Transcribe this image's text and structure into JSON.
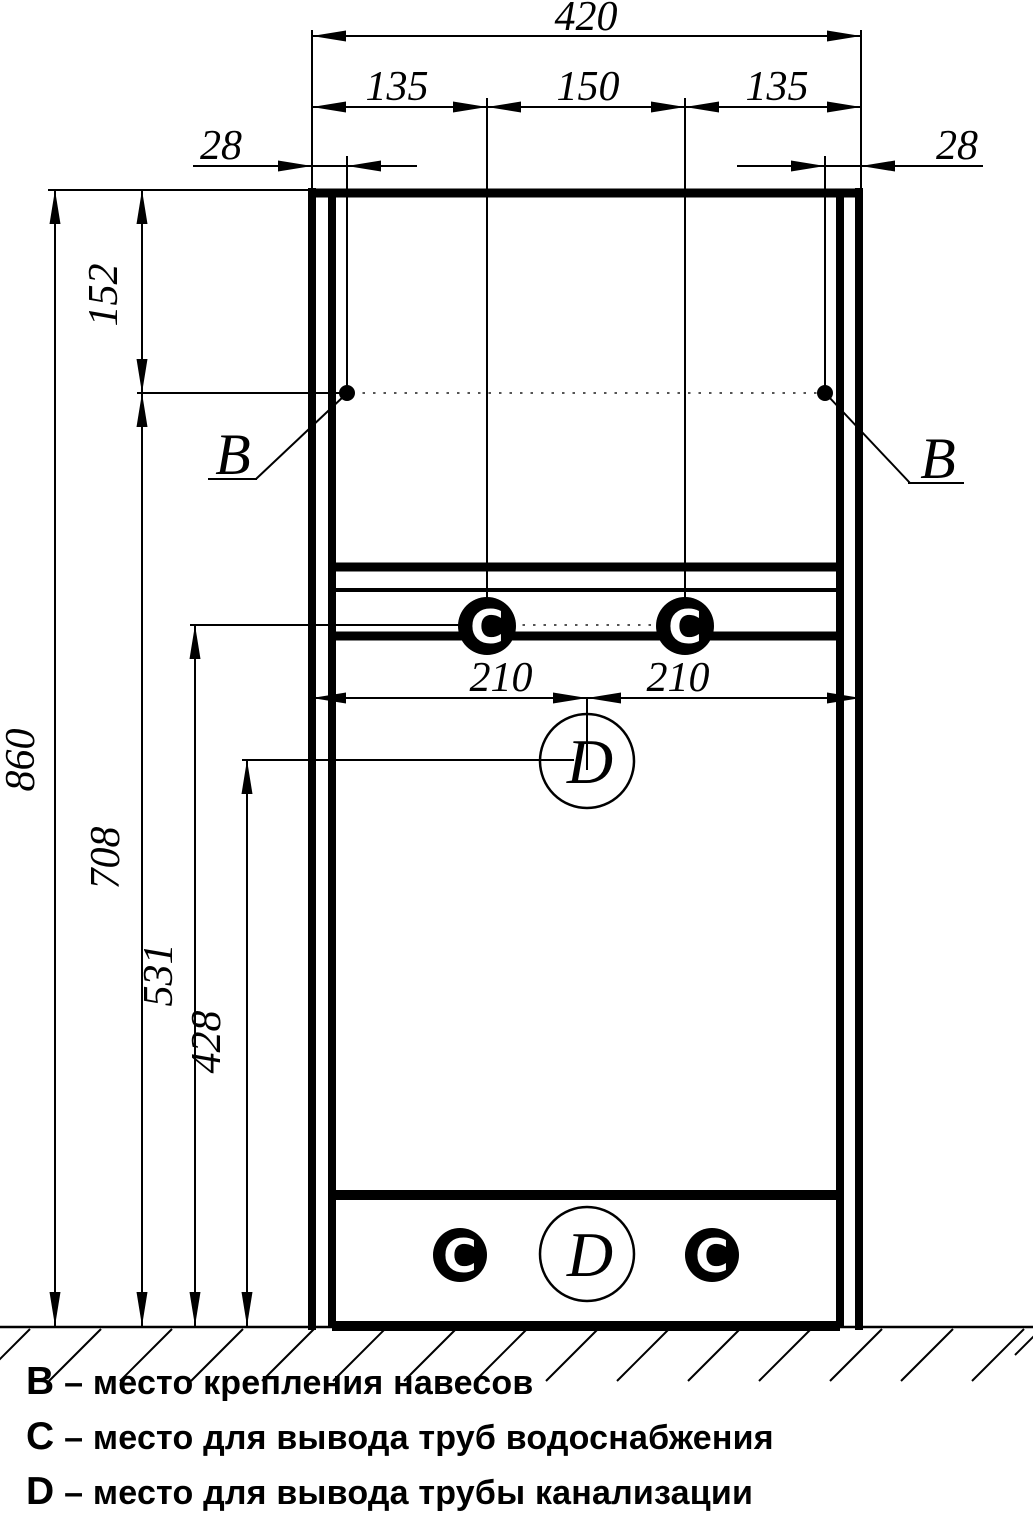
{
  "drawing": {
    "dims": {
      "total_width": "420",
      "seg_left": "135",
      "seg_mid": "150",
      "seg_right": "135",
      "edge_left": "28",
      "edge_right": "28",
      "total_height": "860",
      "top_offset": "152",
      "pipe_level": "708",
      "mid_level": "531",
      "drain_level": "428",
      "half_left": "210",
      "half_right": "210"
    },
    "markers": {
      "hinge": "B",
      "water": "C",
      "drain": "D"
    }
  },
  "legend": {
    "items": [
      {
        "key": "B",
        "text": "– место крепления навесов"
      },
      {
        "key": "C",
        "text": "– место для вывода труб водоснабжения"
      },
      {
        "key": "D",
        "text": "– место для вывода трубы канализации"
      }
    ]
  }
}
